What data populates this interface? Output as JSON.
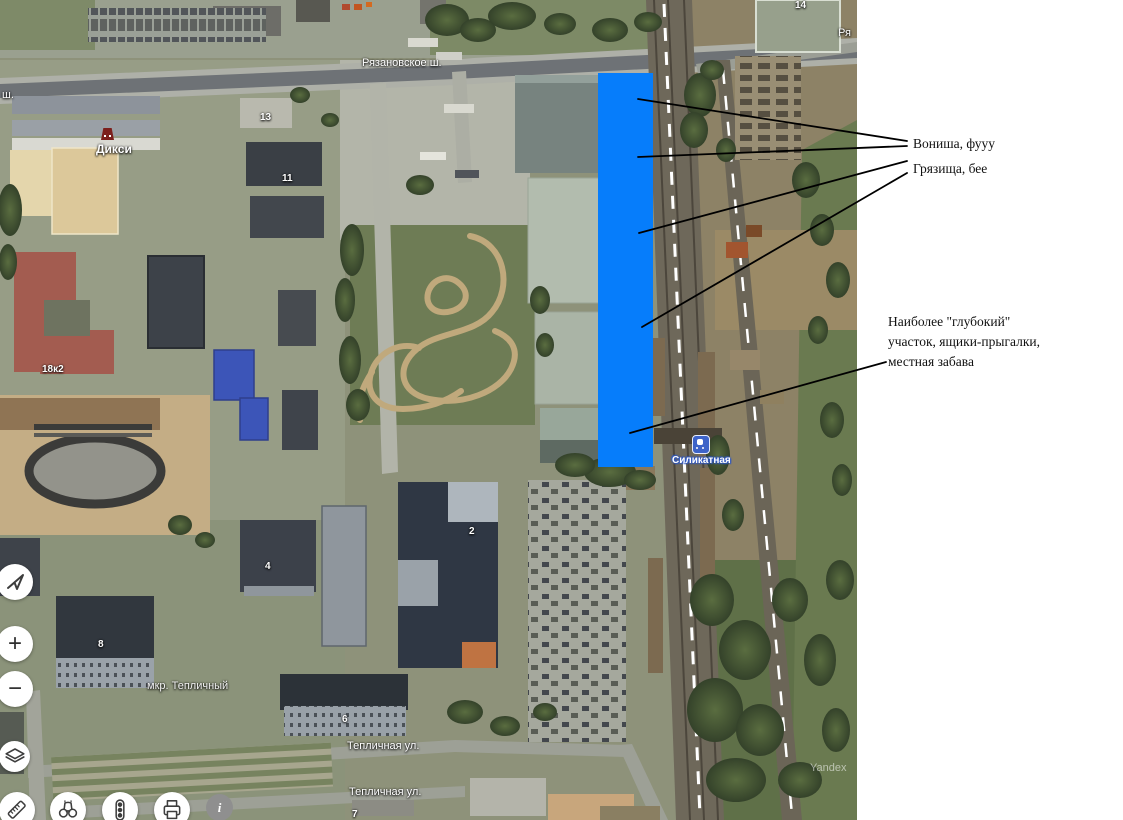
{
  "annotations": {
    "note_smell": "Вониша, фууу",
    "note_dirt": "Грязища, бее",
    "note_deep_line1": "Наиболее \"глубокий\"",
    "note_deep_line2": "участок, ящики-прыгалки,",
    "note_deep_line3": "местная забава"
  },
  "map": {
    "highlight_color": "#067dfb",
    "road_labels": [
      {
        "text": "Рязановское ш."
      },
      {
        "text": "ш."
      },
      {
        "text": "Ря"
      },
      {
        "text": "Тепличная ул."
      },
      {
        "text": "Тепличная ул."
      },
      {
        "text": "мкр. Тепличный"
      }
    ],
    "poi": {
      "store": "Дикси",
      "station": "Силикатная"
    },
    "building_numbers": [
      {
        "text": "14"
      },
      {
        "text": "13"
      },
      {
        "text": "11"
      },
      {
        "text": "18к2"
      },
      {
        "text": "4"
      },
      {
        "text": "2"
      },
      {
        "text": "8"
      },
      {
        "text": "6"
      },
      {
        "text": "7"
      }
    ],
    "watermark": "Yandex"
  },
  "controls": {
    "zoom_in": "+",
    "zoom_out": "−",
    "info": "i"
  }
}
